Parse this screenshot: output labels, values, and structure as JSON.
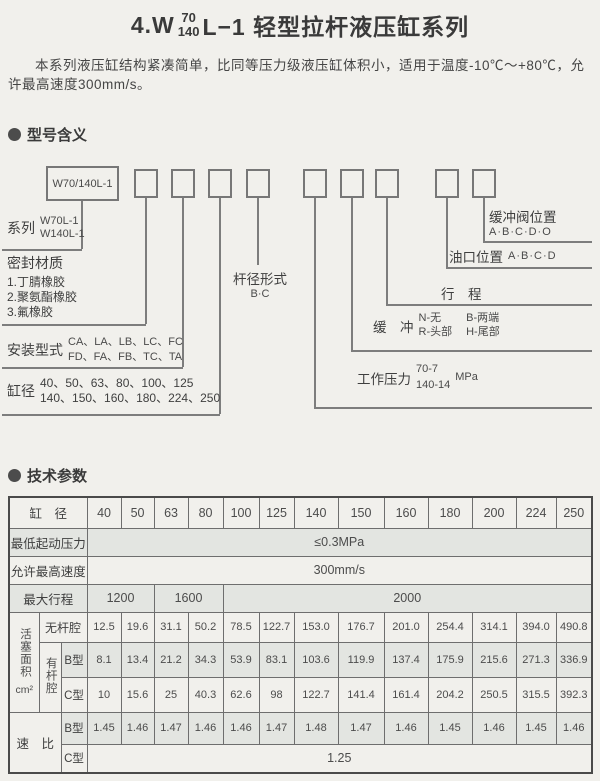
{
  "title": {
    "num": "4.W",
    "frac_top": "70",
    "frac_bottom": "140",
    "rest": "L−1 轻型拉杆液压缸系列"
  },
  "intro": "本系列液压缸结构紧凑简单，比同等压力级液压缸体积小，适用于温度-10℃～+80℃，允许最高速度300mm/s。",
  "sections": {
    "model_meaning": "型号含义",
    "tech_params": "技术参数"
  },
  "diagram": {
    "model_box": "W70/140L-1",
    "series_label": "系列",
    "series_item1": "W70L-1",
    "series_item2": "W140L-1",
    "seal_label": "密封材质",
    "seal_item1": "1.丁腈橡胶",
    "seal_item2": "2.聚氨酯橡胶",
    "seal_item3": "3.氟橡胶",
    "mount_label": "安装型式",
    "mount_line1": "CA、LA、LB、LC、FC",
    "mount_line2": "FD、FA、FB、TC、TA",
    "bore_label": "缸径",
    "bore_line1": "40、50、63、80、100、125",
    "bore_line2": "140、150、160、180、224、250",
    "rod_label": "杆径形式",
    "rod_options": "B·C",
    "pressure_label": "工作压力",
    "pressure_top": "70-7",
    "pressure_bottom": "140-14",
    "pressure_unit": "MPa",
    "cushion_label": "缓　冲",
    "cushion_n": "N-无",
    "cushion_b": "B-两端",
    "cushion_r": "R-头部",
    "cushion_h": "H-尾部",
    "stroke_label": "行　程",
    "port_label": "油口位置",
    "port_options": "A·B·C·D",
    "cvalve_label": "缓冲阀位置",
    "cvalve_options": "A·B·C·D·O"
  },
  "table": {
    "header_label": "缸　径",
    "bores": [
      "40",
      "50",
      "63",
      "80",
      "100",
      "125",
      "140",
      "150",
      "160",
      "180",
      "200",
      "224",
      "250"
    ],
    "min_start_pressure": {
      "label": "最低起动压力",
      "value": "≤0.3MPa"
    },
    "max_speed": {
      "label": "允许最高速度",
      "value": "300mm/s"
    },
    "max_stroke": {
      "label": "最大行程",
      "v1": "1200",
      "v2": "1600",
      "v3": "2000"
    },
    "piston_area_label": "活塞面积",
    "piston_area_unit": "cm²",
    "rodless": {
      "label": "无杆腔",
      "values": [
        "12.5",
        "19.6",
        "31.1",
        "50.2",
        "78.5",
        "122.7",
        "153.0",
        "176.7",
        "201.0",
        "254.4",
        "314.1",
        "394.0",
        "490.8"
      ]
    },
    "rod_side_label": "有杆腔",
    "rod_b": {
      "label": "B型",
      "values": [
        "8.1",
        "13.4",
        "21.2",
        "34.3",
        "53.9",
        "83.1",
        "103.6",
        "119.9",
        "137.4",
        "175.9",
        "215.6",
        "271.3",
        "336.9"
      ]
    },
    "rod_c": {
      "label": "C型",
      "values": [
        "10",
        "15.6",
        "25",
        "40.3",
        "62.6",
        "98",
        "122.7",
        "141.4",
        "161.4",
        "204.2",
        "250.5",
        "315.5",
        "392.3"
      ]
    },
    "ratio_label": "速　比",
    "ratio_b": {
      "label": "B型",
      "values": [
        "1.45",
        "1.46",
        "1.47",
        "1.46",
        "1.46",
        "1.47",
        "1.48",
        "1.47",
        "1.46",
        "1.45",
        "1.46",
        "1.45",
        "1.46"
      ]
    },
    "ratio_c": {
      "label": "C型",
      "value": "1.25"
    }
  }
}
